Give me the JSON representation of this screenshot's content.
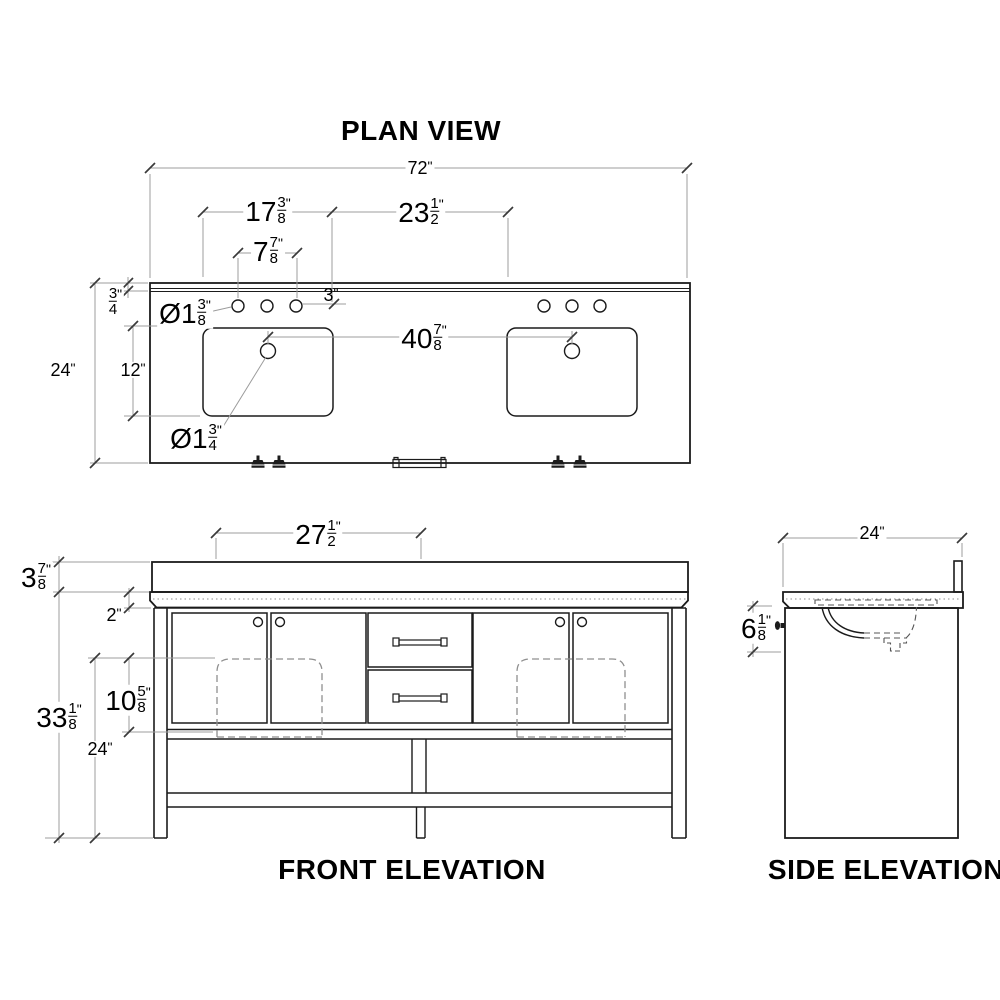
{
  "style": {
    "background": "#ffffff",
    "object_line": "#1b1b1b",
    "dim_line": "#9c9c9c",
    "tick": "#3a3a3a",
    "hidden_line": "#8f8f8f",
    "text": "#000000"
  },
  "plan": {
    "title": "PLAN VIEW",
    "dims": {
      "overall_width": {
        "w": "72",
        "s": "\""
      },
      "sink_cutout_width": {
        "w": "17",
        "n": "3",
        "d": "8",
        "s": "\""
      },
      "sink_spacing": {
        "w": "23",
        "n": "1",
        "d": "2",
        "s": "\""
      },
      "faucet_spread": {
        "w": "7",
        "n": "7",
        "d": "8",
        "s": "\""
      },
      "back_edge_thickness": {
        "n": "3",
        "d": "4",
        "s": "\""
      },
      "hole_setback": {
        "w": "3",
        "s": "\""
      },
      "overall_depth": {
        "w": "24",
        "s": "\""
      },
      "sink_depth": {
        "w": "12",
        "s": "\""
      },
      "faucet_hole_diameter": {
        "p": "Ø",
        "w": "1",
        "n": "3",
        "d": "8",
        "s": "\""
      },
      "drain_center_spacing": {
        "w": "40",
        "n": "7",
        "d": "8",
        "s": "\""
      },
      "drain_diameter": {
        "p": "Ø",
        "w": "1",
        "n": "3",
        "d": "4",
        "s": "\""
      }
    }
  },
  "front": {
    "title": "FRONT ELEVATION",
    "dims": {
      "door_pair_span": {
        "w": "27",
        "n": "1",
        "d": "2",
        "s": "\""
      },
      "splash_counter_height": {
        "w": "3",
        "n": "7",
        "d": "8",
        "s": "\""
      },
      "counter_thickness": {
        "w": "2",
        "s": "\""
      },
      "cabinet_height": {
        "w": "33",
        "n": "1",
        "d": "8",
        "s": "\""
      },
      "bowl_height": {
        "w": "10",
        "n": "5",
        "d": "8",
        "s": "\""
      },
      "leg_clearance": {
        "w": "24",
        "s": "\""
      }
    }
  },
  "side": {
    "title": "SIDE ELEVATION",
    "dims": {
      "depth": {
        "w": "24",
        "s": "\""
      },
      "bowl_depth": {
        "w": "6",
        "n": "1",
        "d": "8",
        "s": "\""
      }
    }
  }
}
